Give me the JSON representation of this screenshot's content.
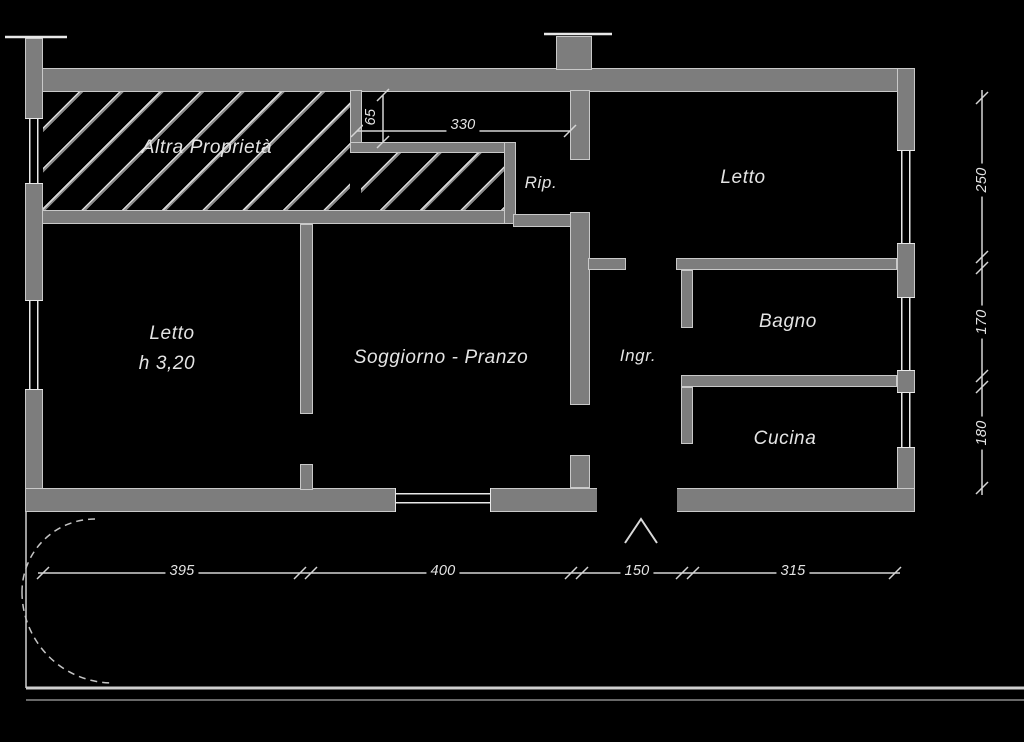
{
  "drawing": {
    "type": "apartment floor plan",
    "language": "Italian"
  },
  "rooms": {
    "altra_proprieta": "Altra Proprietà",
    "letto_left": "Letto",
    "letto_left_height": "h 3,20",
    "soggiorno": "Soggiorno - Pranzo",
    "ripostiglio": "Rip.",
    "letto_right": "Letto",
    "ingresso": "Ingr.",
    "bagno": "Bagno",
    "cucina": "Cucina"
  },
  "dims": {
    "inner_width_330": "330",
    "step_65": "65",
    "right_250": "250",
    "right_170": "170",
    "right_180": "180",
    "bottom_395": "395",
    "bottom_400": "400",
    "bottom_150": "150",
    "bottom_315": "315"
  },
  "colors": {
    "background": "#000000",
    "wall_fill": "#7d7d7d",
    "edge_line": "#c9c9c9",
    "dimension_line": "#d4d4d4",
    "text": "#e4e4e4"
  }
}
